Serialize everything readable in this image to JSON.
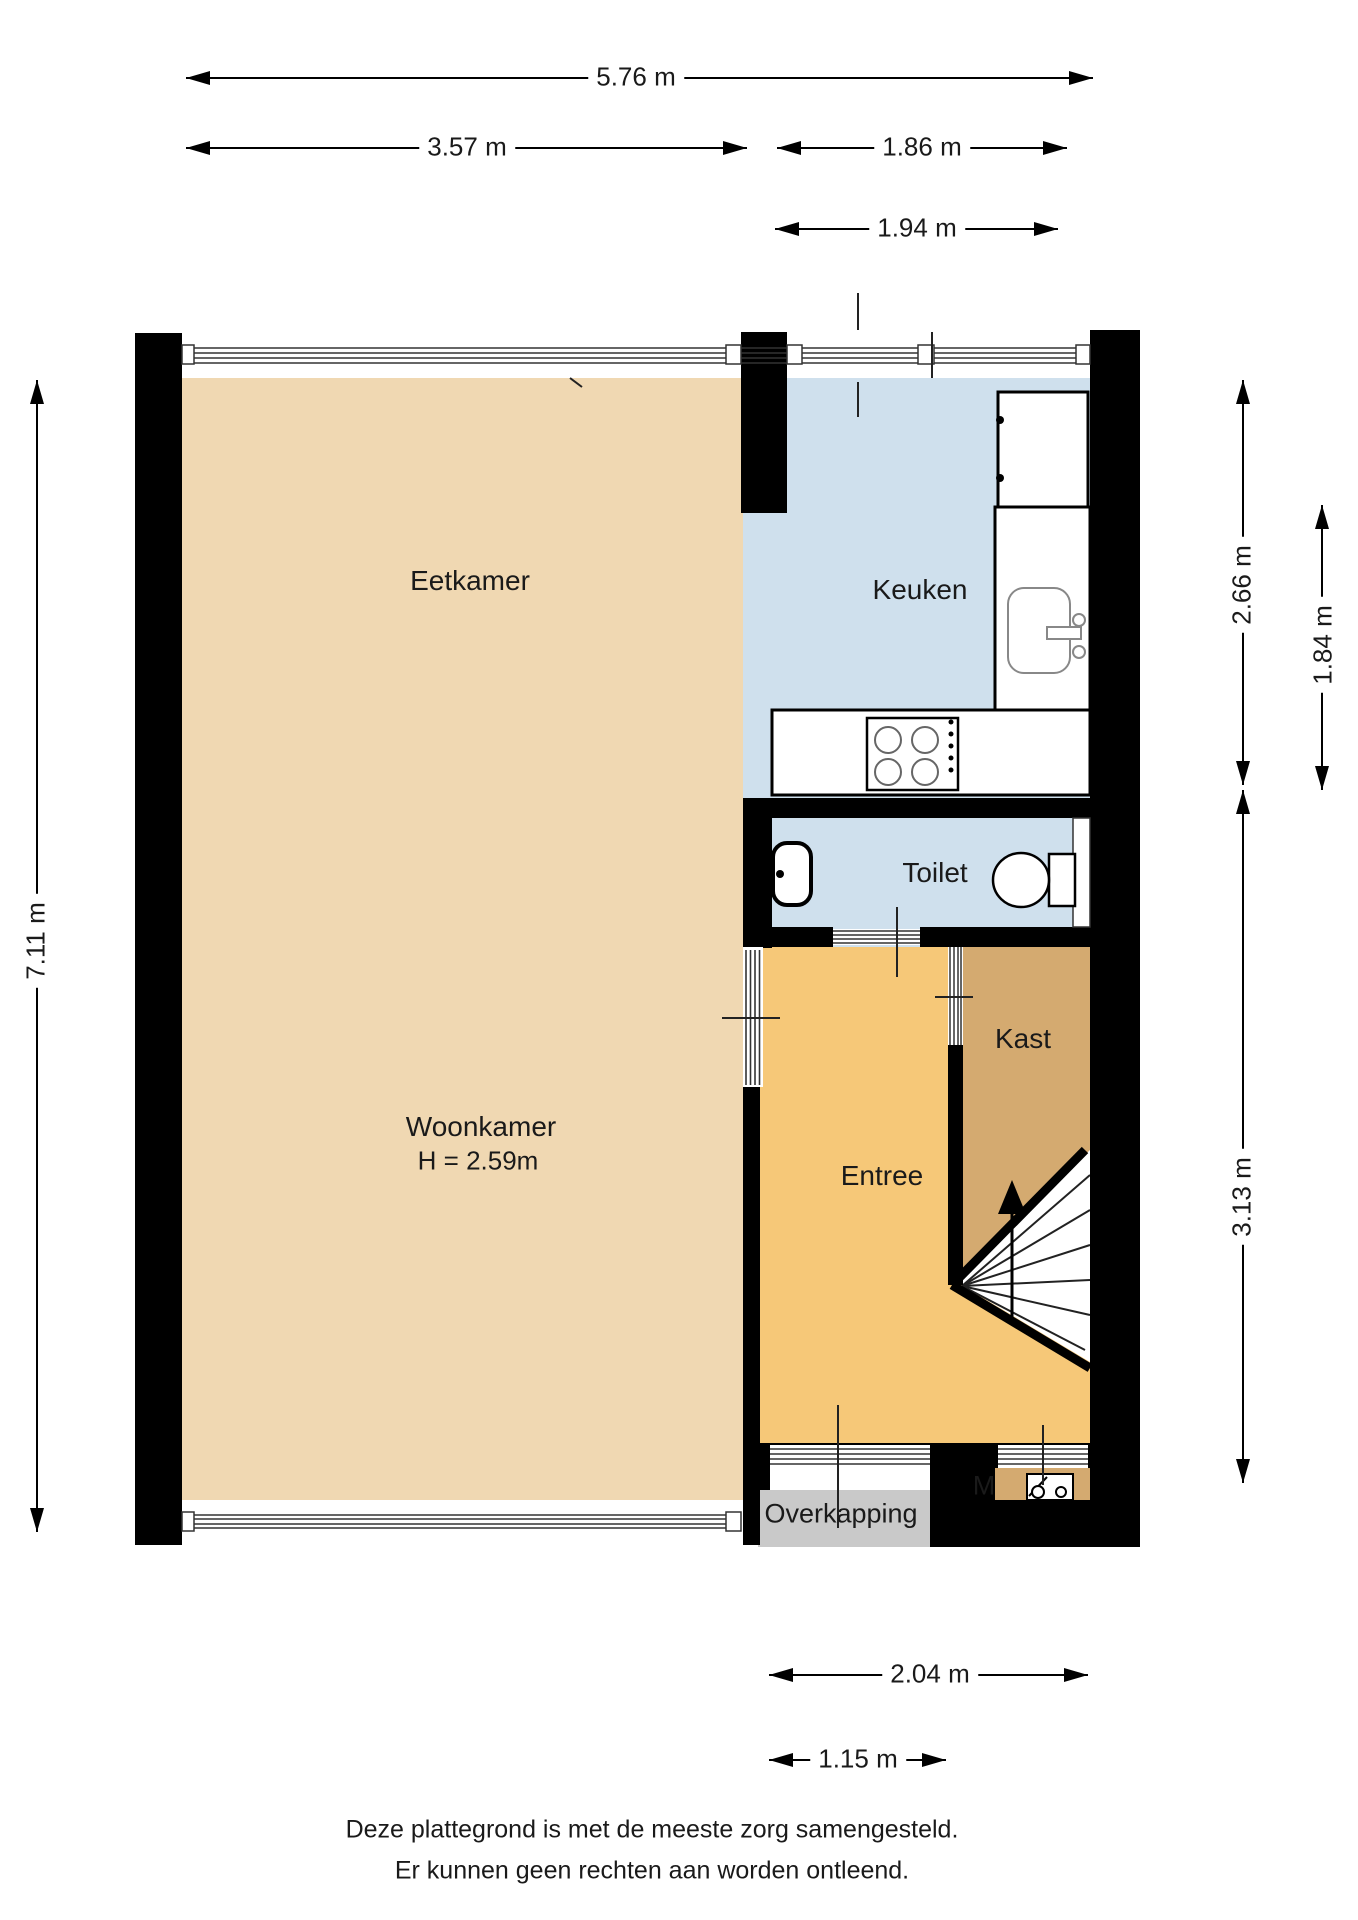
{
  "rooms": {
    "eetkamer": {
      "label": "Eetkamer"
    },
    "keuken": {
      "label": "Keuken"
    },
    "toilet": {
      "label": "Toilet"
    },
    "woonkamer": {
      "label": "Woonkamer",
      "ceiling_height": "H = 2.59m"
    },
    "entree": {
      "label": "Entree"
    },
    "kast": {
      "label": "Kast"
    },
    "overkapping": {
      "label": "Overkapping"
    },
    "meterkast": {
      "label": "M"
    }
  },
  "dimensions": {
    "top_total": "5.76 m",
    "top_left": "3.57 m",
    "top_right": "1.86 m",
    "kitchen_width": "1.94 m",
    "left_height": "7.11 m",
    "right_kitchen_depth": "2.66 m",
    "right_kitchen_inner": "1.84 m",
    "right_lower": "3.13 m",
    "bottom_entree": "2.04 m",
    "bottom_door": "1.15 m"
  },
  "footer": {
    "line1": "Deze plattegrond is met de meeste zorg samengesteld.",
    "line2": "Er kunnen geen rechten aan worden ontleend."
  },
  "icons": {
    "stove": "stove-icon",
    "kitchen_sink": "kitchen-sink-icon",
    "toilet_bowl": "toilet-icon",
    "wash_basin": "basin-icon",
    "stairs": "stairs-up-icon",
    "meter_box": "meter-icon"
  },
  "colors": {
    "room_tan": "#F0D8B2",
    "room_blue": "#CFE0ED",
    "room_orange": "#F6C878",
    "room_dark_tan": "#D4AA70",
    "overkapping_gray": "#C9C9C9",
    "wall_black": "#000000",
    "line_gray": "#777777"
  }
}
